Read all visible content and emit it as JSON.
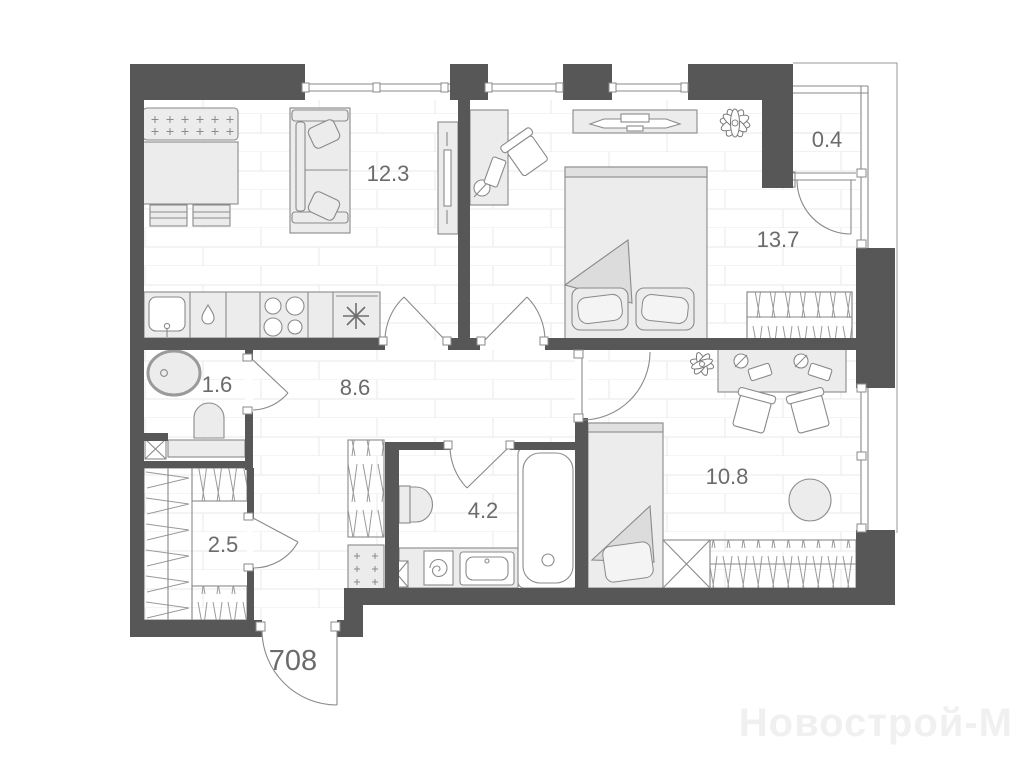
{
  "plan": {
    "apartment_number": "708",
    "watermark": "Новострой-М",
    "rooms": [
      {
        "id": "living-kitchen",
        "area": "12.3"
      },
      {
        "id": "bedroom",
        "area": "13.7"
      },
      {
        "id": "balcony",
        "area": "0.4"
      },
      {
        "id": "wc",
        "area": "1.6"
      },
      {
        "id": "hallway",
        "area": "8.6"
      },
      {
        "id": "storage",
        "area": "2.5"
      },
      {
        "id": "bathroom",
        "area": "4.2"
      },
      {
        "id": "kids-room",
        "area": "10.8"
      }
    ],
    "colors": {
      "wall": "#575757",
      "floor_line": "#ededed",
      "furniture_fill": "#ececec",
      "furniture_stroke": "#8a8a8a",
      "label": "#6b6b6b",
      "watermark": "#f0f0f0"
    }
  }
}
